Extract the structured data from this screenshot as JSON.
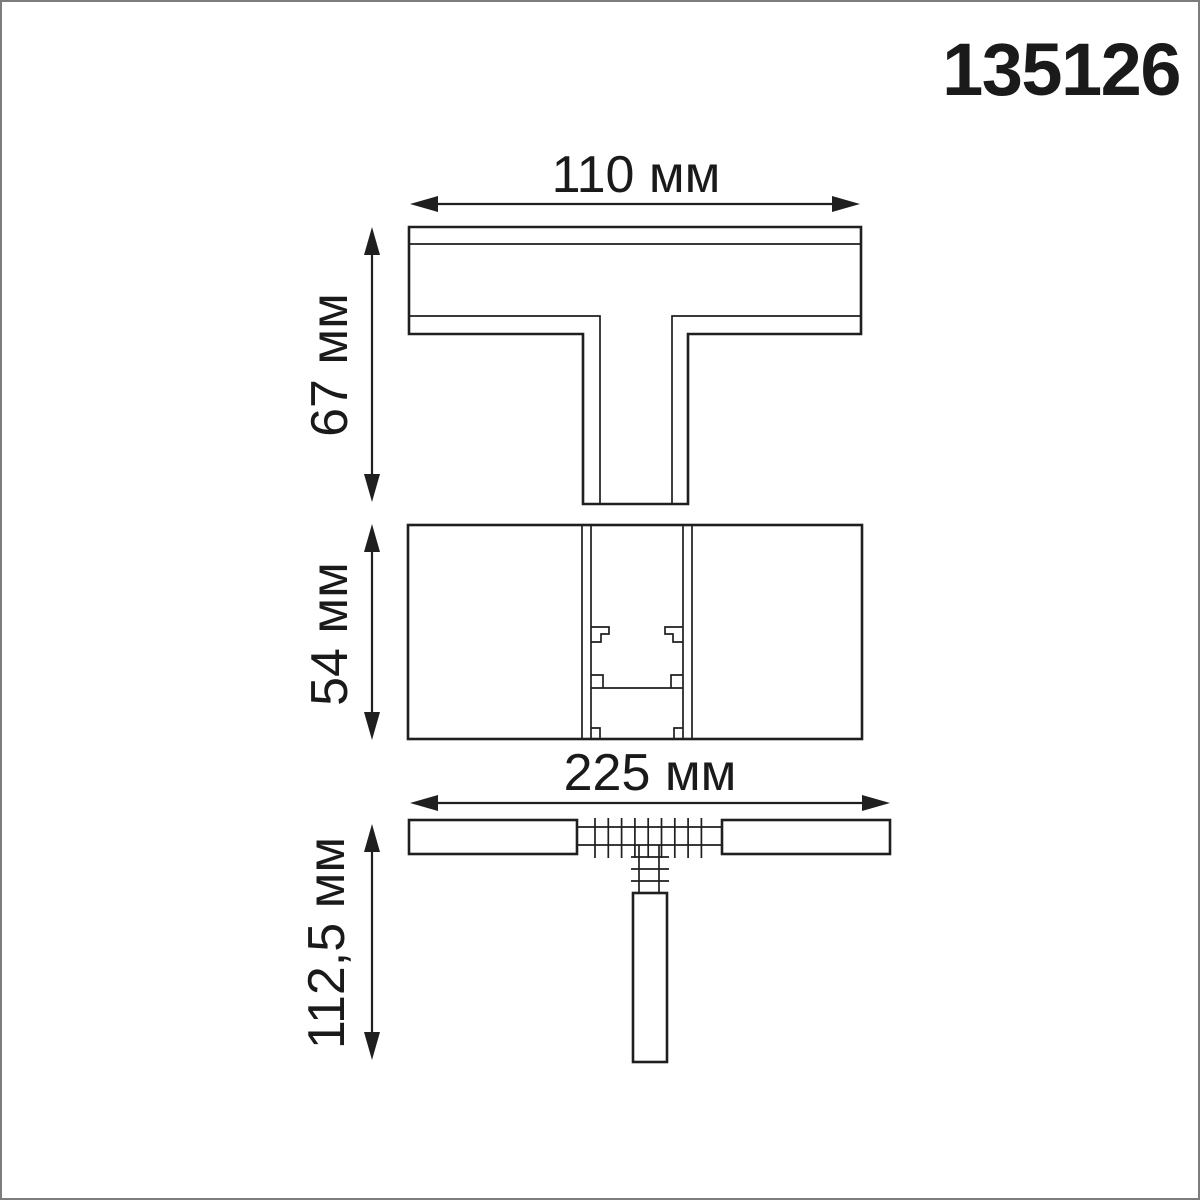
{
  "product_code": "135126",
  "dimensions": {
    "top_width": "110 мм",
    "top_height": "67 мм",
    "front_height": "54 мм",
    "side_width": "225 мм",
    "side_height": "112,5 мм"
  },
  "colors": {
    "line": "#1f1f1f",
    "text": "#1a1a1a",
    "frame": "#7d7d7d",
    "background": "#ffffff"
  }
}
